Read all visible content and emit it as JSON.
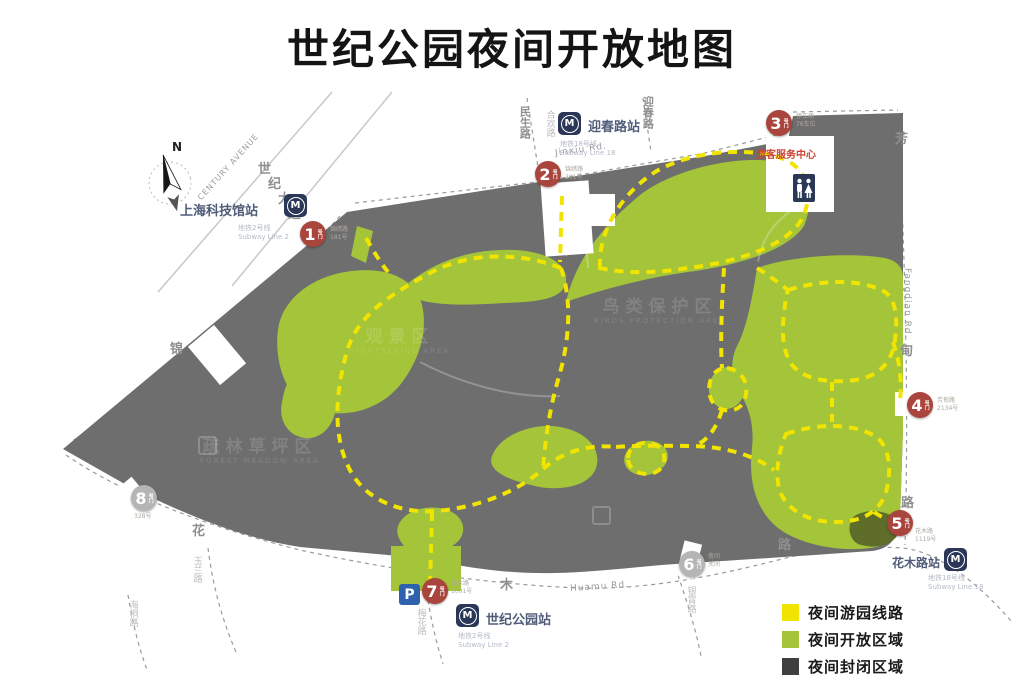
{
  "title": "世纪公园夜间开放地图",
  "legend": {
    "items": [
      {
        "label": "夜间游园线路",
        "color": "#f0e400"
      },
      {
        "label": "夜间开放区域",
        "color": "#a4c43a"
      },
      {
        "label": "夜间封闭区域",
        "color": "#3f3f3f"
      }
    ]
  },
  "compass": {
    "label": "N"
  },
  "stations": {
    "tech_museum": {
      "name": "上海科技馆站",
      "line": "地铁2号线",
      "line_en": "Subway Line 2"
    },
    "yingchun": {
      "name": "迎春路站",
      "line": "地铁18号线",
      "line_en": "Subway Line 18"
    },
    "huamu": {
      "name": "花木路站",
      "line": "地铁18号线",
      "line_en": "Subway Line 18"
    },
    "century_park": {
      "name": "世纪公园站",
      "line": "地铁2号线",
      "line_en": "Subway Line 2"
    }
  },
  "roads": {
    "century_ave_c1": "世",
    "century_ave_c2": "纪",
    "century_ave_c3": "大",
    "century_ave_c4": "道",
    "century_ave_en": "CENTURY AVENUE",
    "jinxiu_en": "Jinxiu Rd.",
    "jinxiu_char": "锦",
    "minsheng": "民生路",
    "hehuan": "合欢路",
    "yingchun_rd": "迎春路",
    "fang": "芳",
    "dian": "甸",
    "fangdian_lu": "路",
    "fangdian_en": "Fangdian Rd.",
    "hua": "花",
    "mu": "木",
    "huamu_lu": "路",
    "huamu_en": "Huamu Rd.",
    "yulan": "玉兰路",
    "meihua": "梅花路",
    "haitong": "海桐路",
    "yinxiao": "银霄路"
  },
  "gates": [
    {
      "num": "1",
      "note1": "锦绣路",
      "note2": "181号"
    },
    {
      "num": "2",
      "note1": "锦绣路",
      "note2": "301号"
    },
    {
      "num": "3",
      "note1": "停车场",
      "note2": "76车位"
    },
    {
      "num": "4",
      "note1": "芳甸路",
      "note2": "2134号"
    },
    {
      "num": "5",
      "note1": "花木路",
      "note2": "1119号"
    },
    {
      "num": "6",
      "note1": "夜间",
      "note2": "关闭"
    },
    {
      "num": "7",
      "note1": "花木路",
      "note2": "1001号"
    },
    {
      "num": "8",
      "note1": "328号",
      "note2": ""
    }
  ],
  "poi": {
    "gate_suffix": "号门",
    "service_center": "游客服务中心",
    "parking": "P"
  },
  "areas": {
    "w1_zh": "疏林草坪区",
    "w1_en": "FOREST MEADOW AREA",
    "w2_zh": "观景区",
    "w2_en": "SIGHTSEEING AREA",
    "w3_zh": "鸟类保护区",
    "w3_en": "BIRDS PROTECTION AREA"
  },
  "map_colors": {
    "closed_area": "#6e6e6e",
    "open_area": "#a4c43a",
    "route_line": "#f0e400",
    "dark_green": "#5e6d2a"
  }
}
